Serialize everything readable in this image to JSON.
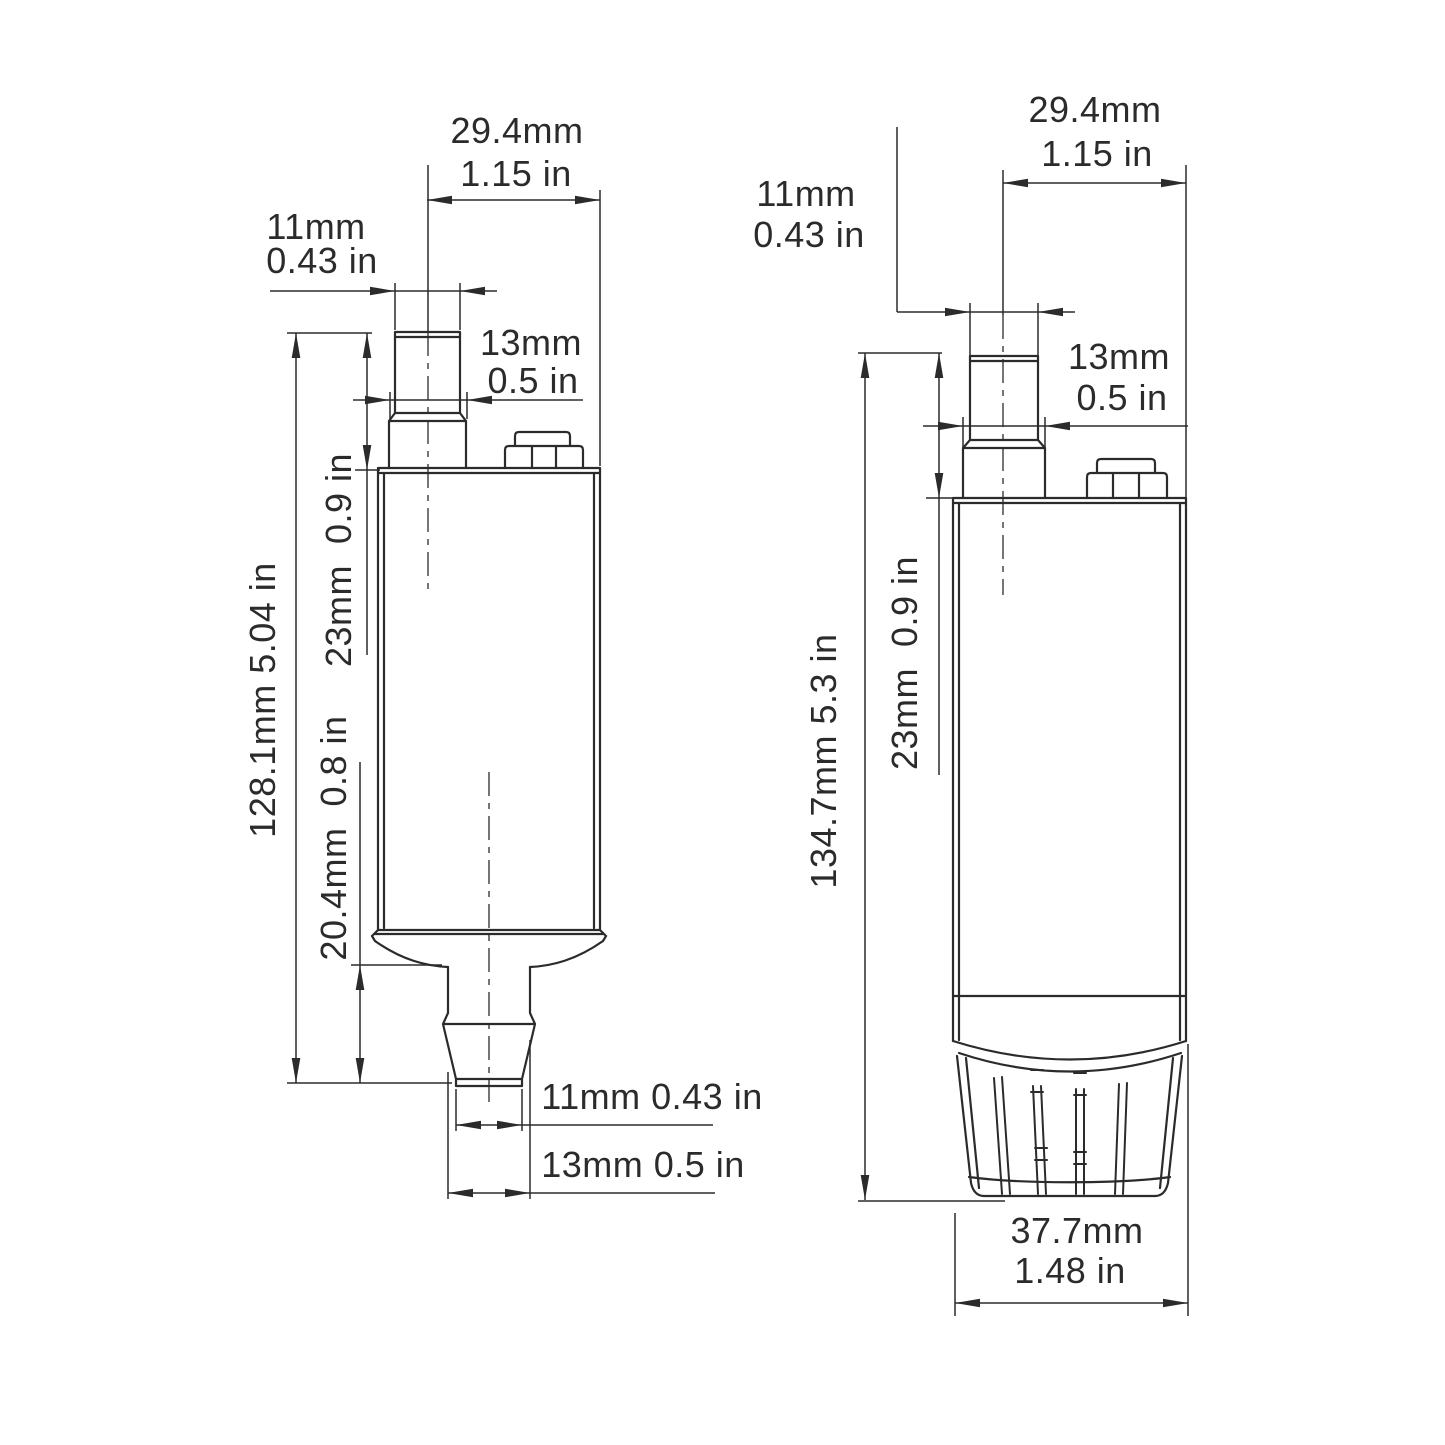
{
  "colors": {
    "ink": "#2b2b2b",
    "background": "#ffffff"
  },
  "left_view": {
    "top_width": {
      "mm": "29.4mm",
      "in": "1.15 in"
    },
    "inlet_od": {
      "mm": "11mm",
      "in": "0.43 in"
    },
    "inlet_base": {
      "mm": "13mm",
      "in": "0.5 in"
    },
    "inlet_height": "23mm  0.9 in",
    "total_height": "128.1mm 5.04 in",
    "outlet_height": "20.4mm  0.8 in",
    "outlet_od": "11mm 0.43 in",
    "outlet_base": "13mm 0.5 in"
  },
  "right_view": {
    "top_width": {
      "mm": "29.4mm",
      "in": "1.15 in"
    },
    "inlet_od": {
      "mm": "11mm",
      "in": "0.43 in"
    },
    "inlet_base": {
      "mm": "13mm",
      "in": "0.5 in"
    },
    "inlet_height": "23mm  0.9 in",
    "total_height": "134.7mm 5.3 in",
    "strainer_width": {
      "mm": "37.7mm",
      "in": "1.48 in"
    }
  }
}
